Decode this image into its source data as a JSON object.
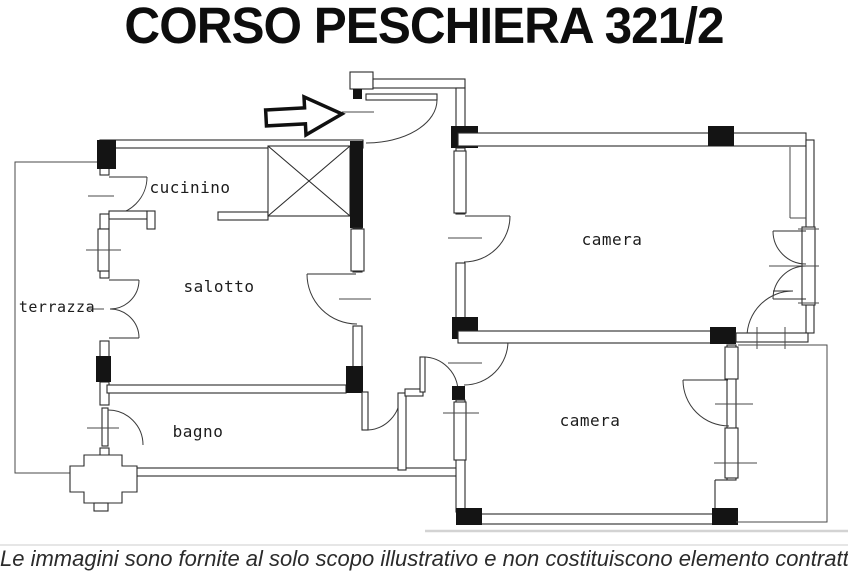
{
  "title": "CORSO PESCHIERA 321/2",
  "disclaimer": "Le immagini sono fornite al solo scopo illustrativo e non costituiscono elemento contrattuale",
  "floorplan": {
    "rooms": [
      {
        "name": "cucinino"
      },
      {
        "name": "salotto"
      },
      {
        "name": "terrazza"
      },
      {
        "name": "bagno"
      },
      {
        "name": "camera"
      },
      {
        "name": "camera"
      }
    ],
    "colors": {
      "ink": "#2b2b2b",
      "wall_fill": "#141414",
      "paper": "#ffffff"
    }
  }
}
